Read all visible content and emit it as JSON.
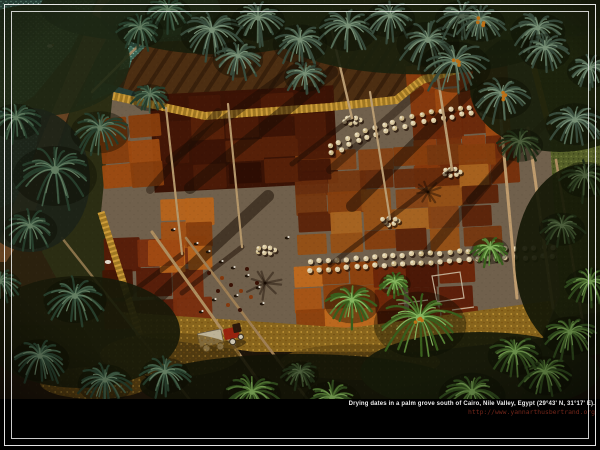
{
  "caption": {
    "title": "Drying dates in a palm grove south of Cairo, Nile Valley, Egypt (29°43' N, 31°17' E).",
    "url": "http://www.yannarthusbertrand.org",
    "title_color": "#ededed",
    "url_color": "#73261a"
  },
  "frame": {
    "outer_inset": 4,
    "inner_inset": 11,
    "color": "#f8f8f8"
  },
  "photo": {
    "description": "Aerial photograph: dates drying on red, rust and orange patchwork plots in a clearing of a palm grove; workers, white sacks, a tractor, a dirt road and teal crop fields around",
    "scene": {
      "bg": "#2a2210",
      "palettes": {
        "teal": [
          "#24402f",
          "#42634c",
          "#68876b"
        ],
        "gray": [
          "#374f41",
          "#58755f",
          "#7e9c82"
        ],
        "green": [
          "#2c4a1e",
          "#4e7634",
          "#74a055"
        ],
        "bright": [
          "#38641f",
          "#5c8f3c",
          "#8cc468"
        ],
        "darkp": [
          "#1c2c16",
          "#33492a",
          "#4e6442"
        ]
      },
      "fields": [
        {
          "pts": "0,0 96,0 70,52 34,96 0,118",
          "base": "#2e5248"
        },
        {
          "pts": "104,0 215,0 212,30 168,58 96,76",
          "base": "#3a6b5c"
        },
        {
          "pts": "0,128 44,108 26,196 0,208",
          "base": "#2e5248"
        }
      ],
      "olive": {
        "pts": "497,55 600,28 600,312 560,318 500,242 492,150",
        "base": "#57652c"
      },
      "tilled": {
        "pts": "150,42 420,30 468,52 424,80 396,100 330,108 205,118 122,92 132,60",
        "base": "#4e3014"
      },
      "road": {
        "pts": "98,0 126,0 70,110 30,225 6,262 0,262 0,238 55,105",
        "fill": "#6b4726"
      },
      "canal": {
        "pts": "128,0 150,0 122,62 92,142 62,238 34,240 62,140 96,58",
        "fill": "#222e1a"
      },
      "pond": {
        "pts": "95,80 150,96 136,142 88,132",
        "fill": "#24403a"
      },
      "murk": {
        "pts": "70,110 113,92 101,212 140,336 100,358 42,252",
        "fill": "#2a2f15"
      },
      "floor": {
        "x": 0,
        "y": 325,
        "w": 340,
        "h": 75,
        "fill": "#1c150a"
      },
      "floor2": {
        "pts": "520,400 545,335 600,315 600,400",
        "fill": "#131108"
      },
      "clearing": {
        "pts": "113,92 205,112 330,103 396,96 420,76 470,62 532,58 548,112 560,295 543,338 420,352 255,352 140,336 101,212",
        "fill": "#756753"
      },
      "goldTop": {
        "d": "M113,96 L205,116 L330,107 L396,100 L422,80 L470,66",
        "w": 8
      },
      "goldBottom": {
        "pts": "120,312 350,328 556,300 543,338 420,352 255,352 140,336",
        "fill": "#8f6c20"
      },
      "goldLeft": {
        "d": "M101,212 L140,336",
        "w": 7
      },
      "goldRight": {
        "d": "M532,60 L550,130",
        "w": 6
      },
      "darkBase": {
        "x": 152,
        "y": 90,
        "w": 184,
        "h": 98,
        "fill": "#3a1306",
        "rot": -3
      },
      "quilts": [
        {
          "x": 411,
          "y": 62,
          "w": 100,
          "h": 124,
          "c": 4,
          "r": 5,
          "rot": -4,
          "pal": [
            "#8a3a0e",
            "#96430f",
            "#7a320c",
            "#a34c12",
            "#6e2a0a",
            "#933f10"
          ]
        },
        {
          "x": 296,
          "y": 148,
          "w": 198,
          "h": 102,
          "c": 6,
          "r": 5,
          "rot": -3,
          "pal": [
            "#7a3a12",
            "#8a4616",
            "#9c5418",
            "#6b2e0e",
            "#a55f1e",
            "#5e240a",
            "#b06a22",
            "#8a4210"
          ]
        },
        {
          "x": 156,
          "y": 94,
          "w": 176,
          "h": 90,
          "c": 5,
          "r": 4,
          "rot": -3,
          "pal": [
            "#3c1406",
            "#4e1c08",
            "#2c0e04",
            "#5a2209",
            "#451707"
          ]
        },
        {
          "x": 100,
          "y": 116,
          "w": 60,
          "h": 72,
          "c": 2,
          "r": 3,
          "rot": -5,
          "pal": [
            "#a34e12",
            "#b25a18",
            "#8e420f"
          ]
        },
        {
          "x": 104,
          "y": 238,
          "w": 102,
          "h": 92,
          "c": 3,
          "r": 3,
          "rot": -2,
          "pal": [
            "#571c08",
            "#6b2409",
            "#451505",
            "#7e3010"
          ]
        },
        {
          "x": 160,
          "y": 198,
          "w": 52,
          "h": 72,
          "c": 2,
          "r": 3,
          "rot": -2,
          "pal": [
            "#a85416",
            "#c16a1e",
            "#8e420f"
          ]
        },
        {
          "x": 294,
          "y": 264,
          "w": 88,
          "h": 66,
          "c": 3,
          "r": 3,
          "rot": -3,
          "pal": [
            "#b05a16",
            "#c96f1f",
            "#94450f"
          ]
        },
        {
          "x": 376,
          "y": 264,
          "w": 96,
          "h": 68,
          "c": 3,
          "r": 3,
          "rot": -3,
          "pal": [
            "#5e1d08",
            "#6e2609",
            "#4a1505"
          ]
        }
      ],
      "brightCell": {
        "x": 148,
        "y": 240,
        "w": 36,
        "h": 26,
        "fill": "#a84e14"
      },
      "whiteMarks": [
        "M432,276 l28,-4 l4,26 l-27,4 Z",
        "M398,304 l30,-4",
        "M452,310 l22,-3"
      ],
      "sweeps": [
        [
          332,
          72,
          190,
          188,
          12,
          0.5
        ],
        [
          300,
          64,
          170,
          160,
          9,
          0.45
        ],
        [
          472,
          88,
          352,
          206,
          12,
          0.5
        ],
        [
          515,
          150,
          428,
          252,
          10,
          0.45
        ],
        [
          268,
          196,
          160,
          296,
          12,
          0.5
        ],
        [
          218,
          112,
          150,
          190,
          8,
          0.4
        ],
        [
          548,
          120,
          470,
          200,
          8,
          0.4
        ],
        [
          420,
          90,
          330,
          170,
          8,
          0.4
        ]
      ],
      "shadowPalms": [
        [
          265,
          283,
          20
        ],
        [
          428,
          192,
          15
        ]
      ],
      "sackRows": [
        {
          "x1": 330,
          "y1": 146,
          "cx": 400,
          "cy": 112,
          "x2": 480,
          "y2": 106,
          "rows": 2,
          "ox": 2,
          "oy": 7,
          "n": 17,
          "r": 2.6
        },
        {
          "x1": 310,
          "y1": 262,
          "cx": 430,
          "cy": 252,
          "x2": 553,
          "y2": 247,
          "rows": 2,
          "ox": 0,
          "oy": 9,
          "n": 27,
          "r": 2.7
        }
      ],
      "clusters": [
        [
          352,
          118
        ],
        [
          452,
          170
        ],
        [
          390,
          219
        ],
        [
          266,
          248
        ]
      ],
      "trunks": [
        [
          352,
          118,
          326,
          6,
          2.4,
          "#c4a87c",
          1
        ],
        [
          452,
          170,
          430,
          26,
          2.6,
          "#c4a87c",
          1
        ],
        [
          390,
          219,
          370,
          92,
          2.2,
          "#c4a87c",
          1
        ],
        [
          182,
          254,
          166,
          108,
          2.2,
          "#bfa274",
          1
        ],
        [
          242,
          247,
          228,
          104,
          2.2,
          "#bfa274",
          1
        ],
        [
          517,
          298,
          498,
          88,
          3,
          "#caa878",
          0
        ],
        [
          553,
          308,
          528,
          128,
          3,
          "#caa878",
          0
        ],
        [
          584,
          330,
          556,
          160,
          2.6,
          "#b8966a",
          0
        ],
        [
          152,
          232,
          272,
          400,
          3,
          "#b89868",
          0
        ],
        [
          186,
          238,
          308,
          400,
          2.6,
          "#a8885c",
          0
        ],
        [
          62,
          238,
          190,
          400,
          2.4,
          "#907a50",
          0
        ],
        [
          92,
          92,
          178,
          6,
          2.4,
          "#a8906a",
          0
        ]
      ],
      "piles": [
        [
          222,
          278
        ],
        [
          231,
          285
        ],
        [
          241,
          291
        ],
        [
          251,
          297
        ],
        [
          218,
          291
        ],
        [
          257,
          283
        ],
        [
          247,
          269
        ],
        [
          209,
          273
        ],
        [
          228,
          305
        ],
        [
          240,
          310
        ]
      ],
      "figures": [
        [
          196,
          244
        ],
        [
          208,
          252
        ],
        [
          221,
          262
        ],
        [
          233,
          268
        ],
        [
          247,
          276
        ],
        [
          258,
          288
        ],
        [
          236,
          296
        ],
        [
          214,
          300
        ],
        [
          201,
          312
        ],
        [
          262,
          304
        ],
        [
          287,
          238
        ],
        [
          173,
          230
        ]
      ],
      "donkeys": [
        [
          50,
          46
        ],
        [
          147,
          42
        ]
      ],
      "animal": [
        108,
        262
      ],
      "tractor": {
        "x": 196,
        "y": 328,
        "rot": -12
      },
      "straw": [
        [
          170,
          355,
          70,
          22
        ],
        [
          95,
          383,
          55,
          16
        ],
        [
          360,
          362,
          80,
          18
        ]
      ],
      "canopyBlobs": [
        [
          40,
          60,
          90,
          70,
          "#1d2a16"
        ],
        [
          220,
          16,
          120,
          48,
          "#16200e"
        ],
        [
          420,
          28,
          150,
          58,
          "#18220f"
        ],
        [
          560,
          88,
          90,
          80,
          "#141d0c"
        ],
        [
          585,
          260,
          70,
          120,
          "#101808"
        ],
        [
          80,
          332,
          100,
          70,
          "#151a0a"
        ],
        [
          300,
          386,
          160,
          40,
          "#0f1408"
        ],
        [
          480,
          372,
          120,
          50,
          "#121a0a"
        ],
        [
          30,
          180,
          60,
          90,
          "#1a241a"
        ],
        [
          130,
          8,
          90,
          40,
          "#1b2917"
        ],
        [
          520,
          8,
          120,
          40,
          "#18230f"
        ]
      ],
      "palms": [
        [
          212,
          30,
          30,
          "gray"
        ],
        [
          258,
          18,
          26,
          "gray"
        ],
        [
          238,
          56,
          24,
          "gray"
        ],
        [
          300,
          40,
          26,
          "gray"
        ],
        [
          305,
          74,
          20,
          "gray"
        ],
        [
          348,
          26,
          28,
          "gray"
        ],
        [
          390,
          16,
          24,
          "gray"
        ],
        [
          428,
          40,
          30,
          "gray"
        ],
        [
          462,
          16,
          26,
          "gray"
        ],
        [
          455,
          62,
          34,
          "gray"
        ],
        [
          502,
          94,
          28,
          "gray"
        ],
        [
          538,
          28,
          26,
          "gray"
        ],
        [
          545,
          48,
          24,
          "gray"
        ],
        [
          480,
          20,
          24,
          "gray"
        ],
        [
          575,
          120,
          28,
          "gray"
        ],
        [
          590,
          68,
          22,
          "gray"
        ],
        [
          520,
          142,
          22,
          "darkp"
        ],
        [
          168,
          10,
          22,
          "teal"
        ],
        [
          140,
          28,
          22,
          "teal"
        ],
        [
          150,
          95,
          18,
          "teal"
        ],
        [
          55,
          170,
          40,
          "teal"
        ],
        [
          100,
          128,
          28,
          "teal"
        ],
        [
          16,
          118,
          24,
          "teal"
        ],
        [
          30,
          226,
          26,
          "teal"
        ],
        [
          75,
          296,
          30,
          "teal"
        ],
        [
          40,
          356,
          28,
          "teal"
        ],
        [
          105,
          380,
          26,
          "teal"
        ],
        [
          0,
          282,
          20,
          "teal"
        ],
        [
          585,
          176,
          24,
          "darkp"
        ],
        [
          562,
          226,
          22,
          "darkp"
        ],
        [
          590,
          282,
          24,
          "green"
        ],
        [
          570,
          332,
          26,
          "green"
        ],
        [
          545,
          372,
          26,
          "green"
        ],
        [
          165,
          372,
          24,
          "teal"
        ],
        [
          252,
          392,
          28,
          "green"
        ],
        [
          332,
          398,
          28,
          "green"
        ],
        [
          420,
          318,
          44,
          "bright"
        ],
        [
          352,
          300,
          26,
          "bright"
        ],
        [
          395,
          282,
          15,
          "bright"
        ],
        [
          472,
          392,
          32,
          "green"
        ],
        [
          515,
          352,
          26,
          "green"
        ],
        [
          300,
          372,
          18,
          "darkp"
        ],
        [
          490,
          248,
          18,
          "bright"
        ]
      ],
      "fruited": [
        [
          502,
          94
        ],
        [
          480,
          20
        ],
        [
          420,
          318
        ],
        [
          455,
          62
        ]
      ]
    }
  }
}
